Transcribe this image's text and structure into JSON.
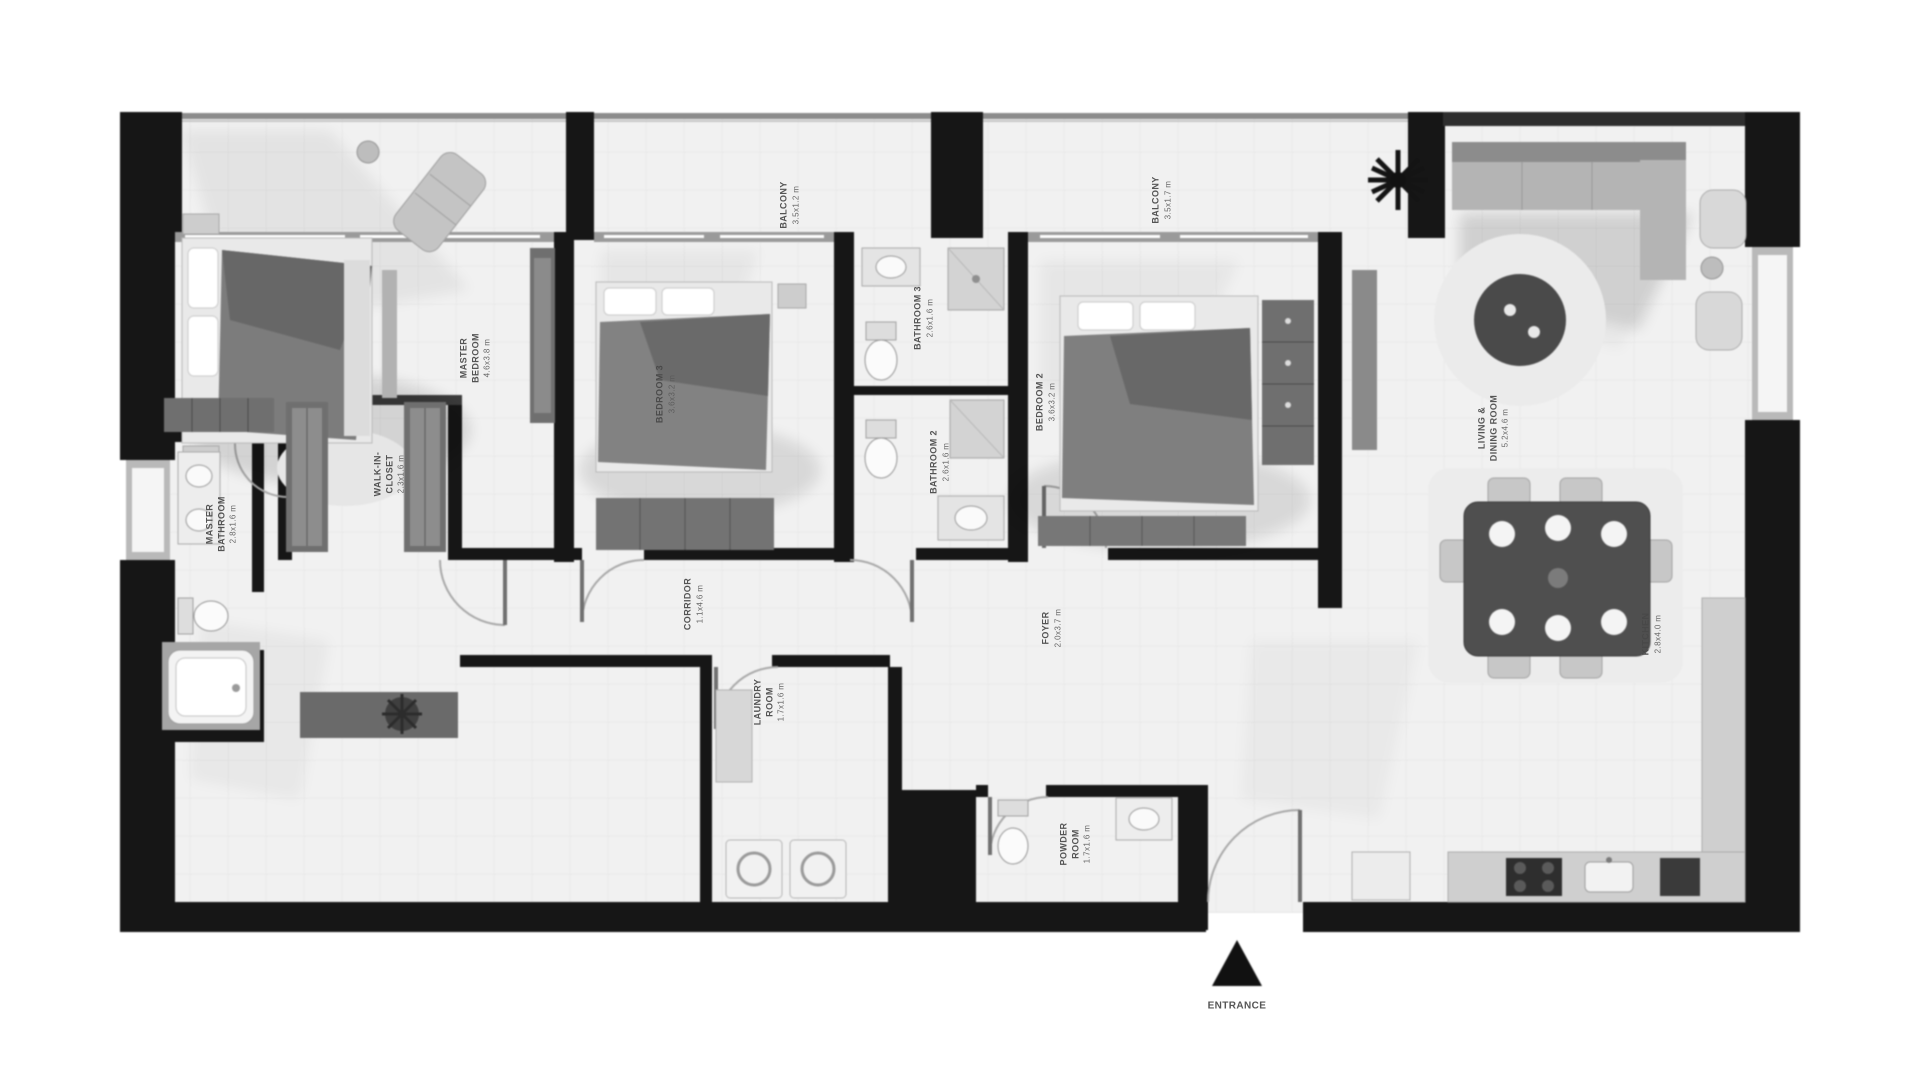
{
  "title": "Apartment floor plan",
  "colors": {
    "wall": "#161616",
    "floor": "#f0f0f0",
    "grid": "#e2e2e2",
    "window_frame": "#9a9a9a",
    "furniture_dark": "#5f5f5f",
    "furniture_mid": "#9a9a9a",
    "furniture_light": "#d9d9d9",
    "label_text": "#474747",
    "entrance_marker": "#111111"
  },
  "rooms": {
    "balcony1": {
      "name": "BALCONY",
      "dims": "3.5x1.2 m"
    },
    "balcony2": {
      "name": "BALCONY",
      "dims": "3.5x1.7 m"
    },
    "master_bedroom": {
      "name": "MASTER BEDROOM",
      "dims": "4.6x3.8 m"
    },
    "master_bathroom": {
      "name": "MASTER BATHROOM",
      "dims": "2.8x1.6 m"
    },
    "walk_in_closet": {
      "name": "WALK-IN-CLOSET",
      "dims": "2.3x1.6 m"
    },
    "bedroom3": {
      "name": "BEDROOM 3",
      "dims": "3.6x3.2 m"
    },
    "bathroom3": {
      "name": "BATHROOM 3",
      "dims": "2.6x1.6 m"
    },
    "bathroom2": {
      "name": "BATHROOM 2",
      "dims": "2.6x1.6 m"
    },
    "bedroom2": {
      "name": "BEDROOM 2",
      "dims": "3.6x3.2 m"
    },
    "corridor": {
      "name": "CORRIDOR",
      "dims": "1.1x4.6 m"
    },
    "laundry": {
      "name": "LAUNDRY ROOM",
      "dims": "1.7x1.6 m"
    },
    "powder_room": {
      "name": "POWDER ROOM",
      "dims": "1.7x1.6 m"
    },
    "foyer": {
      "name": "FOYER",
      "dims": "2.0x3.7 m"
    },
    "living_dining": {
      "name": "LIVING & DINING ROOM",
      "dims": "5.2x4.6 m"
    },
    "kitchen": {
      "name": "KITCHEN",
      "dims": "2.8x4.0 m"
    }
  },
  "entrance": {
    "label": "ENTRANCE"
  }
}
